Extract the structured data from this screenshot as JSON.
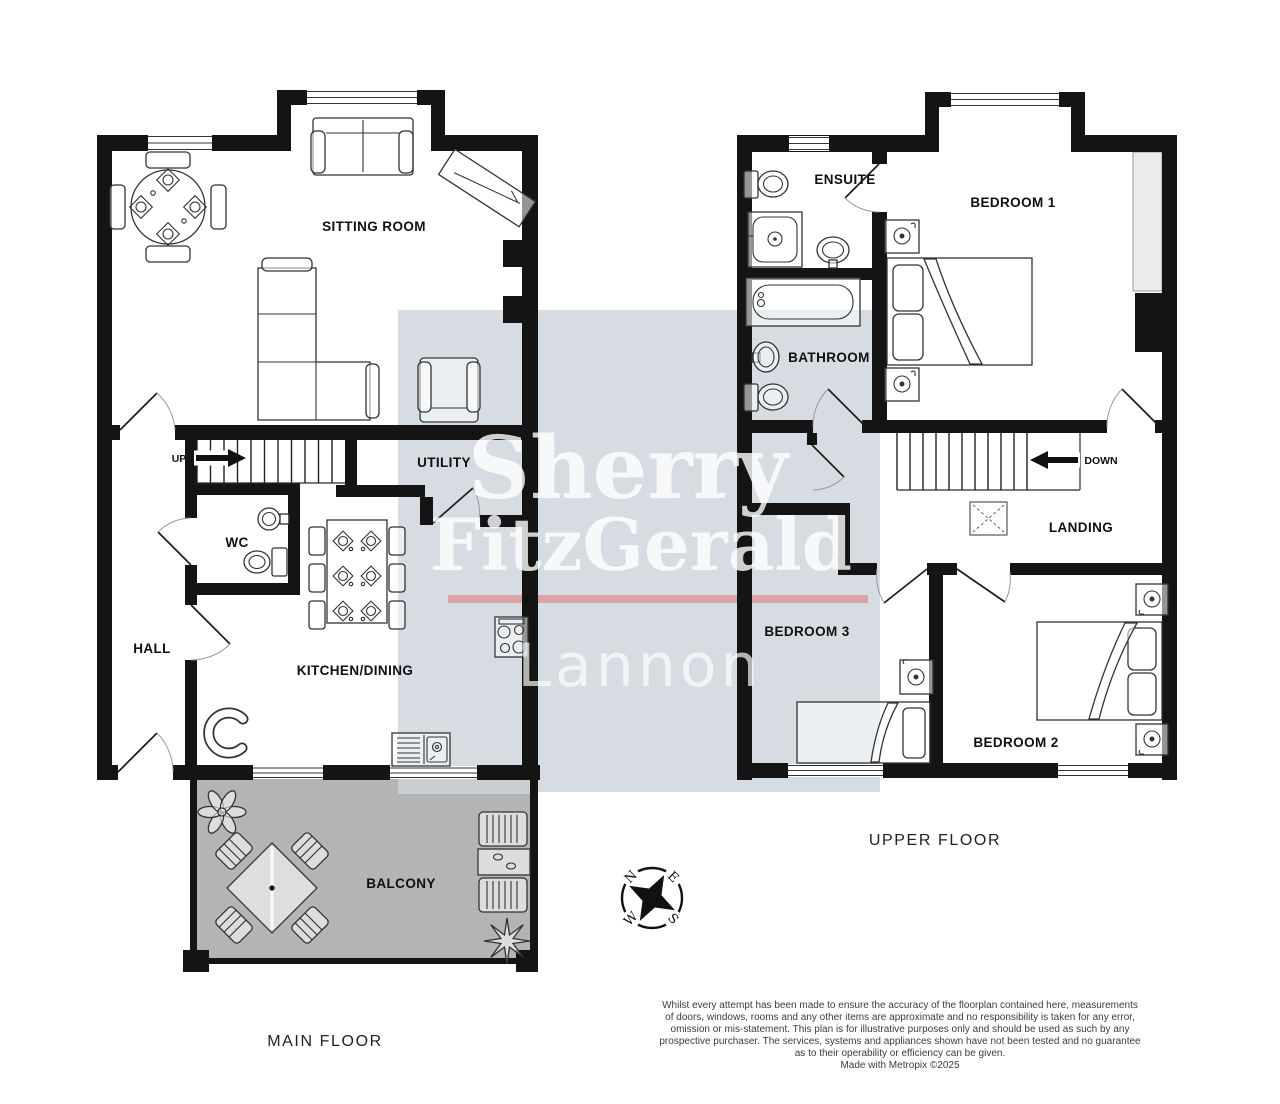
{
  "main_floor": {
    "floor_label": "MAIN FLOOR",
    "rooms": {
      "sitting_room": "SITTING ROOM",
      "utility": "UTILITY",
      "wc": "WC",
      "hall": "HALL",
      "kitchen_dining": "KITCHEN/DINING",
      "balcony": "BALCONY"
    },
    "stair_direction": "UP"
  },
  "upper_floor": {
    "floor_label": "UPPER FLOOR",
    "rooms": {
      "ensuite": "ENSUITE",
      "bedroom_1": "BEDROOM 1",
      "bathroom": "BATHROOM",
      "landing": "LANDING",
      "bedroom_3": "BEDROOM 3",
      "bedroom_2": "BEDROOM 2"
    },
    "stair_direction": "DOWN"
  },
  "watermark": {
    "brand_line1": "Sherry",
    "brand_line2": "FitzGerald",
    "office": "Lannon",
    "panel_color": "#d6dce2",
    "accent_color": "#dba3a3"
  },
  "compass": {
    "north": "N",
    "east": "E",
    "south": "S",
    "west": "W"
  },
  "footer": {
    "disclaimer_lines": [
      "Whilst every attempt has been made to ensure the accuracy of the floorplan contained here, measurements",
      "of doors, windows, rooms and any other items are approximate and no responsibility is taken for any error,",
      "omission or mis-statement. This plan is for illustrative purposes only and should be used as such by any",
      "prospective purchaser. The services, systems and appliances shown have not been tested and no guarantee",
      "as to their operability or efficiency can be given.",
      "Made with Metropix ©2025"
    ]
  },
  "colors": {
    "wall": "#141414",
    "balcony_floor": "#b4b4b4",
    "wardrobe_fill": "#ececec"
  }
}
